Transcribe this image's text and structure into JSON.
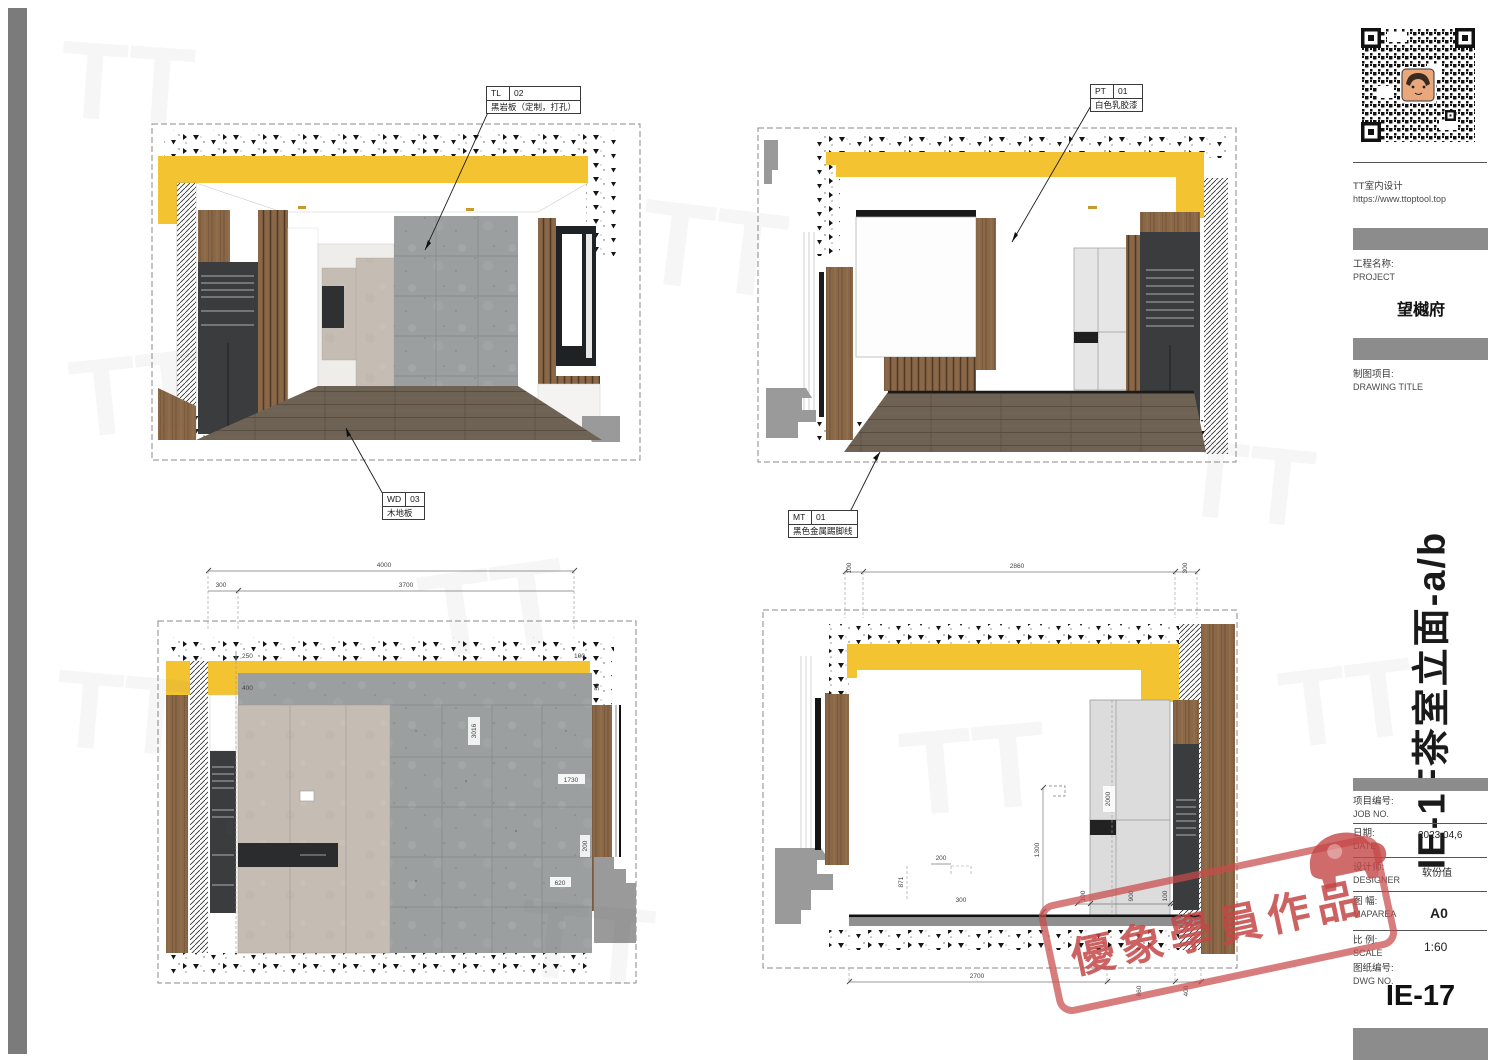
{
  "sheet": {
    "number": "IE-17"
  },
  "company": {
    "name": "TT室内设计",
    "url": "https://www.ttoptool.top"
  },
  "title_block": {
    "project_label_cn": "工程名称:",
    "project_label_en": "PROJECT",
    "project_name": "望樾府",
    "drawing_label_cn": "制图项目:",
    "drawing_label_en": "DRAWING TITLE",
    "drawing_title": "IE-1F茶室立面-a/b",
    "job_label_cn": "项目编号:",
    "job_label_en": "JOB NO.",
    "date_label_cn": "日期:",
    "date_label_en": "DATE",
    "date_value": "2023,04,6",
    "designer_label_cn": "设计师:",
    "designer_label_en": "DESIGNER",
    "designer_value": "软份值",
    "maparea_label_cn": "图 幅:",
    "maparea_label_en": "MAPAREA",
    "maparea_value": "A0",
    "scale_label_cn": "比 例:",
    "scale_label_en": "SCALE",
    "scale_value": "1:60",
    "dwg_label_cn": "图纸编号:",
    "dwg_label_en": "DWG NO."
  },
  "stamp": {
    "text": "優象學員作品"
  },
  "materials": {
    "tl": {
      "code": "TL",
      "num": "02",
      "desc": "黑岩板（定制，打孔）"
    },
    "wd": {
      "code": "WD",
      "num": "03",
      "desc": "木地板"
    },
    "pt": {
      "code": "PT",
      "num": "01",
      "desc": "白色乳胶漆"
    },
    "mt": {
      "code": "MT",
      "num": "01",
      "desc": "黑色金属踢脚线"
    }
  },
  "dims": {
    "c": {
      "total": "4000",
      "seg_left": "300",
      "seg_right": "3700",
      "band": "250",
      "band2": "400",
      "top_r1": "100",
      "top_r2": "50",
      "left_v": "2000",
      "mid_v": "3016",
      "right_h": "1730",
      "right_low": "620",
      "right_edge": "200"
    },
    "d": {
      "t1": "100",
      "t2": "2860",
      "t3": "300",
      "b1": "2700",
      "b2": "860",
      "b3": "400",
      "door_v": "2000",
      "wall_v": "1300",
      "c1": "871",
      "c2": "200",
      "c3": "300",
      "f1": "100",
      "f2": "900",
      "f3": "100"
    }
  },
  "colors": {
    "accent_yellow": "#F3C332",
    "wood": "#8A6847",
    "concrete": "#9C9FA0",
    "dark_cabinet": "#3A3C3E",
    "stamp_red": "#C84B4B",
    "bar_gray": "#8C8C8C"
  },
  "watermark": {
    "text": "TT"
  }
}
